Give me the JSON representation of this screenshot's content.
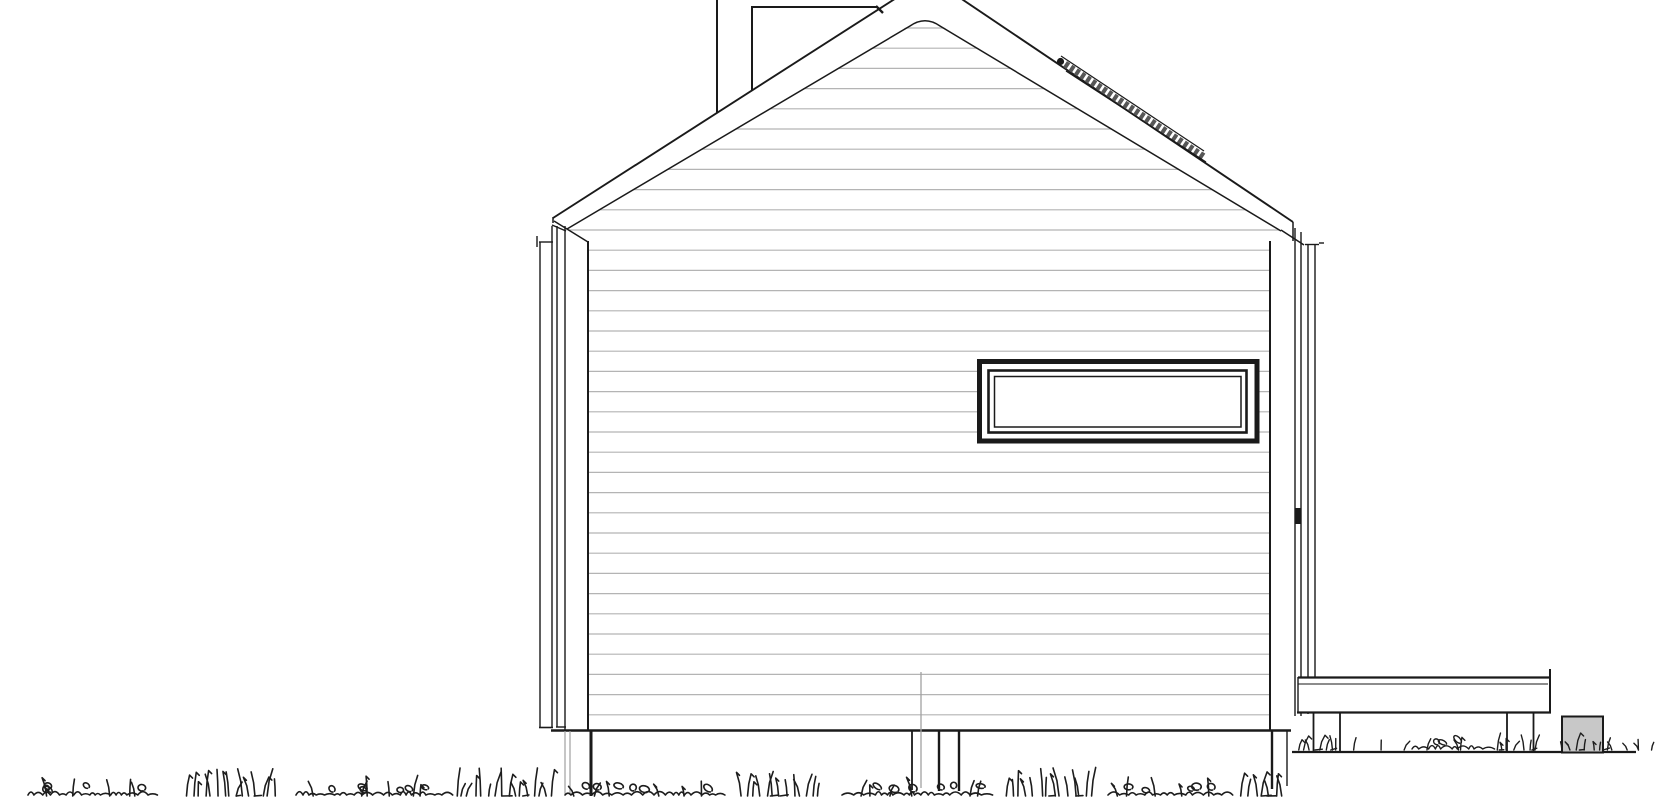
{
  "document": {
    "kind": "architectural-elevation-drawing",
    "title": "House side elevation - gable roof, horizontal board siding, ribbon window, roof rail, chimney, raised side deck on posts, grass ground line",
    "background": "#ffffff",
    "colors": {
      "bg": "#ffffff",
      "ink": "#1a1a1a",
      "siding-line": "#b4b4b4",
      "light-line": "#a0a0a0",
      "grass": "#1d1d1d",
      "box-fill": "#c8c8c8",
      "skylight-band": "#565656"
    }
  },
  "siding": {
    "first_line_y": 28,
    "line_spacing": 20.2,
    "line_count": 35,
    "x_start": 546,
    "x_end": 1293
  },
  "grass": {
    "lower_band": {
      "baseline_y": 796,
      "clumps": [
        {
          "x": 28,
          "w": 127,
          "type": "loops",
          "h": 16
        },
        {
          "x": 183,
          "w": 95,
          "type": "blades",
          "h": 26
        },
        {
          "x": 296,
          "w": 150,
          "type": "loops",
          "h": 16
        },
        {
          "x": 452,
          "w": 106,
          "type": "blades",
          "h": 26
        },
        {
          "x": 565,
          "w": 153,
          "type": "loops",
          "h": 16
        },
        {
          "x": 740,
          "w": 82,
          "type": "blades",
          "h": 27
        },
        {
          "x": 842,
          "w": 148,
          "type": "loops",
          "h": 16
        },
        {
          "x": 1004,
          "w": 94,
          "type": "blades",
          "h": 26
        },
        {
          "x": 1108,
          "w": 124,
          "type": "loops",
          "h": 16
        },
        {
          "x": 1240,
          "w": 46,
          "type": "blades",
          "h": 24
        }
      ]
    },
    "upper_band": {
      "baseline_y": 750,
      "clumps": [
        {
          "x": 1294,
          "w": 48,
          "type": "blades",
          "h": 18
        },
        {
          "x": 1350,
          "w": 56,
          "type": "sparse",
          "h": 12
        },
        {
          "x": 1412,
          "w": 76,
          "type": "loops",
          "h": 10
        },
        {
          "x": 1492,
          "w": 48,
          "type": "blades",
          "h": 17
        },
        {
          "x": 1556,
          "w": 16,
          "type": "sparse",
          "h": 10
        },
        {
          "x": 1576,
          "w": 42,
          "type": "blades",
          "h": 16
        },
        {
          "x": 1622,
          "w": 33,
          "type": "sparse",
          "h": 12
        }
      ]
    }
  }
}
